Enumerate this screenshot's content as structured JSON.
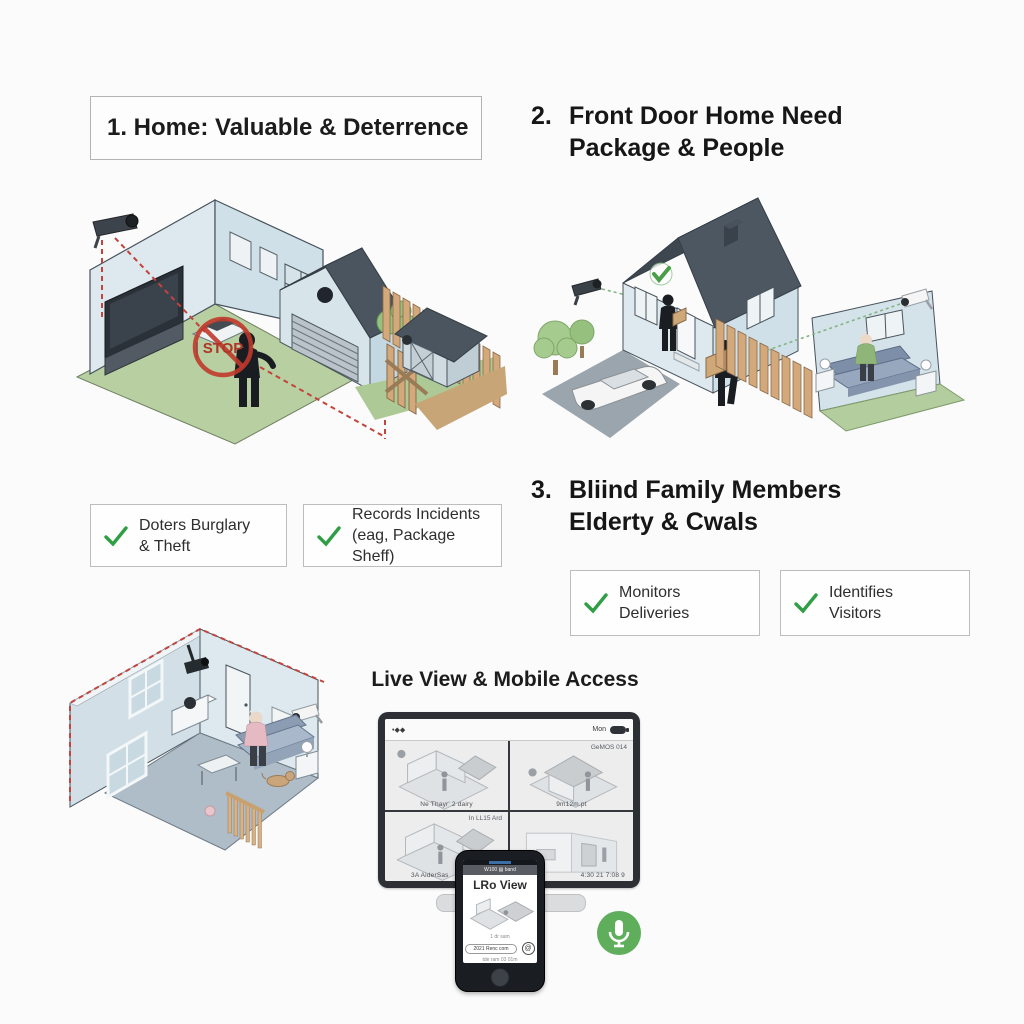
{
  "titles": {
    "s1": "1. Home: Valuable & Deterrence",
    "s2_num": "2.",
    "s2_line1": "Front Door Home Need",
    "s2_line2": "Package & People",
    "s3_num": "3.",
    "s3_line1": "Bliind Family Members",
    "s3_line2": "Elderty & Cwals",
    "s4": "Live View & Mobile Access"
  },
  "checklist": {
    "items": [
      {
        "line1": "Doters Burglary",
        "line2": "& Theft"
      },
      {
        "line1": "Records Incidents",
        "line2": "(eag, Package Sheff)"
      },
      {
        "line1": "Monitors",
        "line2": "Deliveries"
      },
      {
        "line1": "Identifies",
        "line2": "Visitors"
      }
    ]
  },
  "scene1": {
    "stop_label": "STOP"
  },
  "monitor": {
    "menubar_left": "•◆◆",
    "menubar_right": "Mon",
    "feed1_caption": "Ne Thayr' 2 dairy",
    "feed2_overlay": "GeMOS 014",
    "feed2_caption": "9m12m.pt",
    "feed3_overlay": "In LL15 Ard",
    "feed3_caption": "3A AiderSas",
    "feed4_caption": "4:30 21 7:08 9"
  },
  "phone": {
    "toolbar_text": "W100 ▤ band",
    "app_title": "LRo View",
    "small_line1": "1 dr sam",
    "button_label": "2021 Renc com",
    "small_line2": "tde ram 03 01m",
    "at_glyph": "@"
  },
  "colors": {
    "check_green": "#2f9e44",
    "alert_red": "#c0392b",
    "mic_green": "#5fae5c"
  }
}
